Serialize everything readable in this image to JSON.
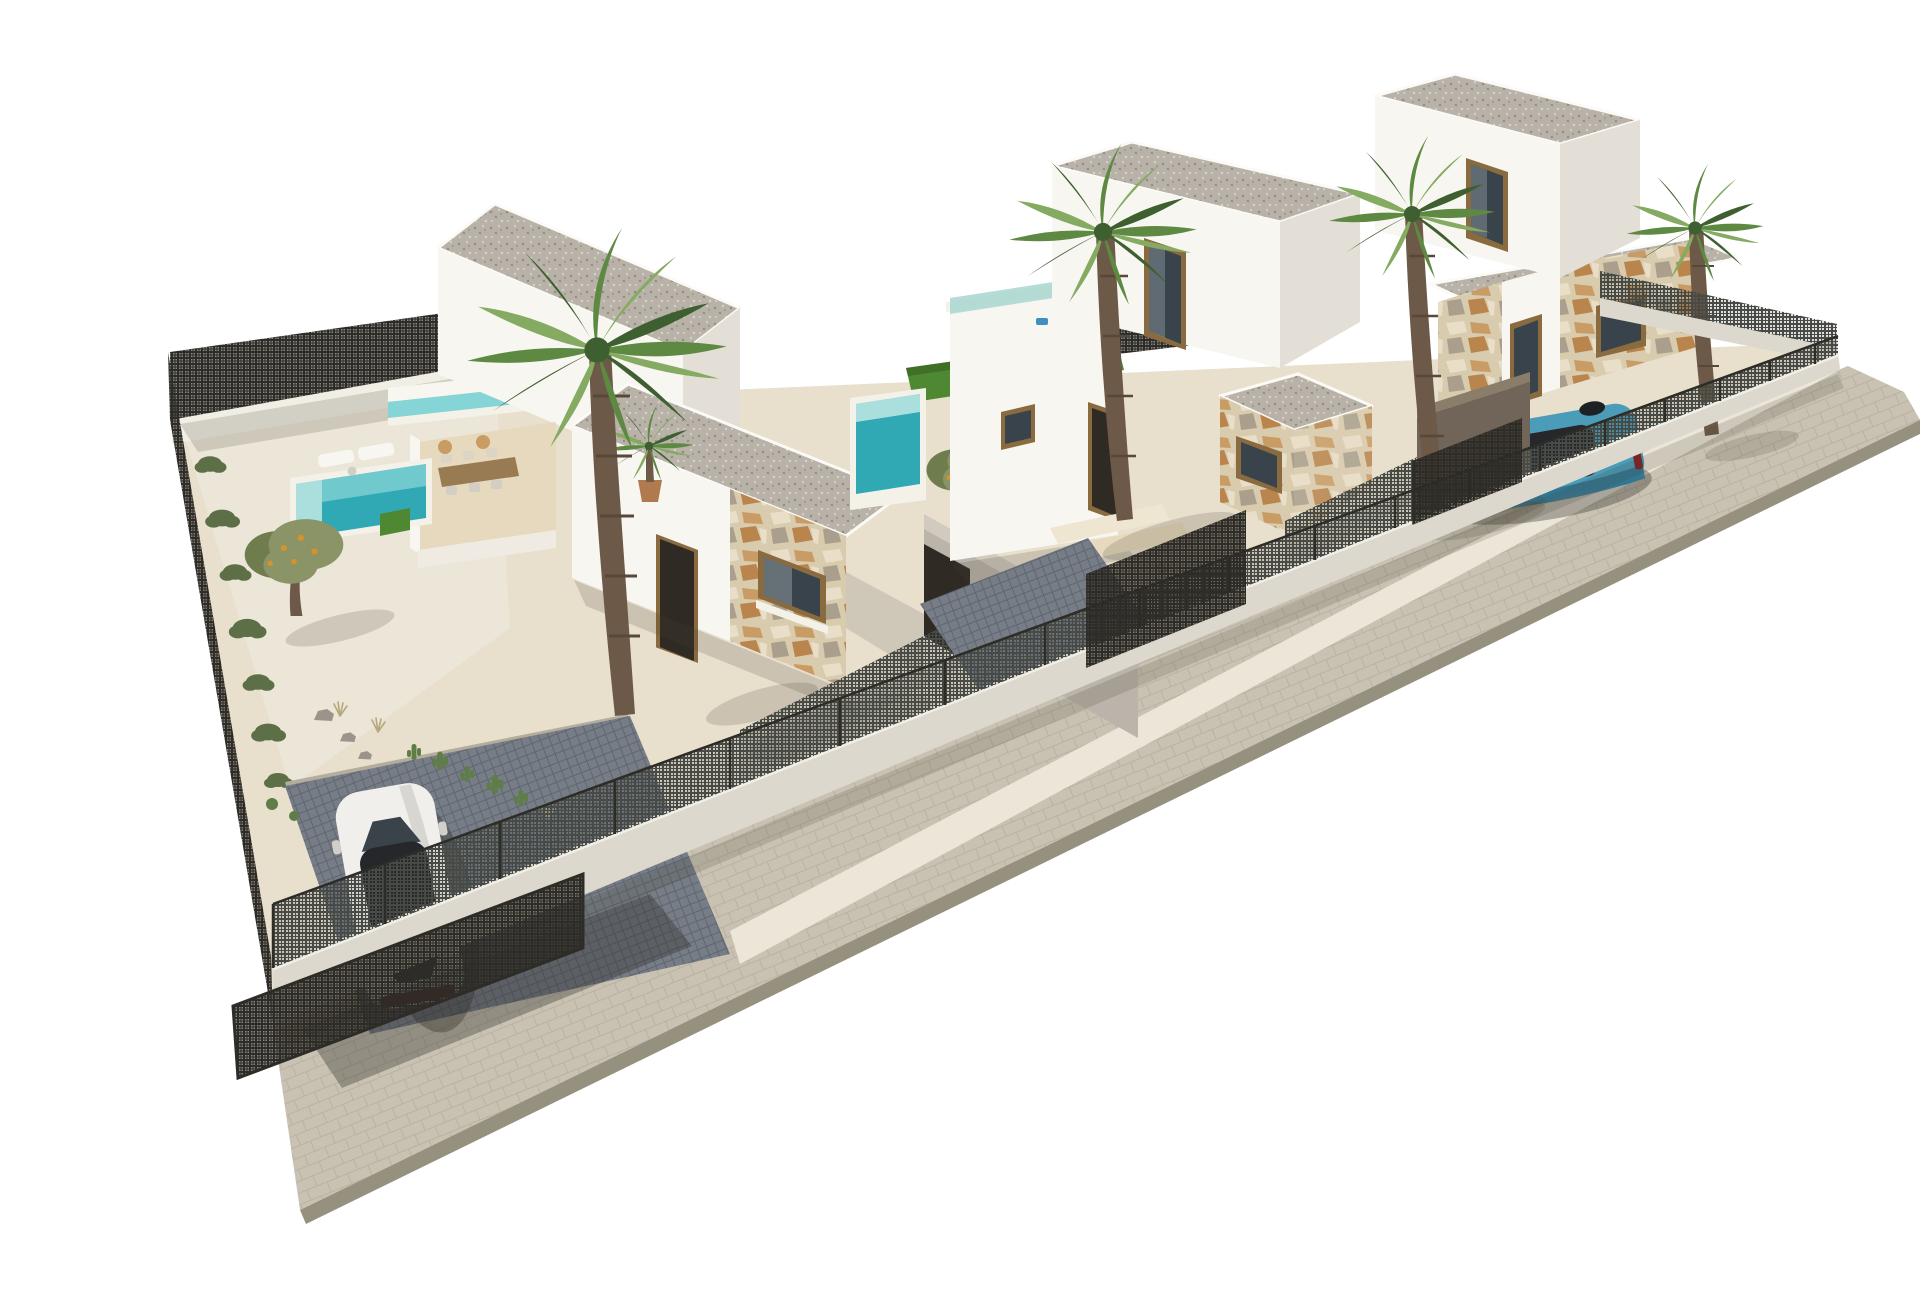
{
  "meta": {
    "title": "Aerial 3D architectural rendering of a gated development of three modern white villas with pools, palm trees and parked cars on a white background",
    "image_type": "3d-architectural-render",
    "background": "#ffffff"
  },
  "palette": {
    "bg": "#ffffff",
    "parapet": "#fbfaf6",
    "wall_lit": "#f8f6f1",
    "wall_mid": "#efebe3",
    "wall_shade": "#e3dfd6",
    "wall_dark": "#d3cec4",
    "roof_gravel": "#b8b2a8",
    "roof_dot_dark": "#948d81",
    "roof_dot_light": "#d8d3c9",
    "ground_cream": "#e8dfcd",
    "ground_gravel": "#ece6d8",
    "gravel_shade": "#ddd5c4",
    "terrace_floor": "#e6d9bd",
    "step_light": "#efe6d2",
    "driveway": "#767d87",
    "driveway_line": "#5f6670",
    "driveway_edge": "#b4ac9c",
    "sidewalk": "#c9c2b3",
    "sidewalk_line": "#b9b1a1",
    "sidewalk_edge": "#96907f",
    "pool_deep": "#31a9b4",
    "pool_light": "#85d4d6",
    "pool_step": "#aadfdd",
    "pool_coping": "#f4f1e9",
    "lawn": "#4f8833",
    "lawn_dark": "#3f7026",
    "glass_teal": "#a8d6d0",
    "glass_dark": "#39434b",
    "glass_sky": "#b9c7cc",
    "mesh_dark": "#2e2c27",
    "mesh_mid": "#474a45",
    "fence_wall": "#f1eee6",
    "fence_wall_face": "#ddd8cd",
    "stone_base": "#d9cbae",
    "stone_warm": "#c89c64",
    "stone_orange": "#b9854d",
    "stone_gray": "#a99f8c",
    "stone_light": "#e9dfc8",
    "frame_brown": "#8a6a3f",
    "frame_dark": "#6e5330",
    "door_dark": "#2f2a24",
    "trunk_brown": "#6d5947",
    "trunk_dark": "#57483a",
    "palm_dark": "#3e6030",
    "palm_mid": "#5e8943",
    "palm_light": "#85aa62",
    "olive_green": "#8a9466",
    "olive_dark": "#6e7c4e",
    "fruit_orange": "#d9912c",
    "shrub_green": "#5c6f46",
    "cactus_green": "#5f7d46",
    "rock_gray": "#9a948a",
    "grass_tan": "#b7a77c",
    "agave_green": "#7e936b",
    "car_white": "#f0efec",
    "car_white_shade": "#d2cfca",
    "car_glass": "#25272b",
    "car_red": "#7c2128",
    "car_blue": "#4b9cb8",
    "car_blue_dark": "#2f7390",
    "court_wall": "#bab4aa",
    "court_wall_lit": "#d0cabf",
    "brown_wall": "#71655a",
    "passage_floor": "#cfc8b9",
    "pot_terracotta": "#b07a4e",
    "shadow": "rgba(70,64,52,0.18)",
    "shadow_strong": "rgba(45,42,35,0.34)"
  },
  "scene": {
    "setting": "Corner plot seen from a high oblique viewpoint; the row of villas recedes diagonally from the large near plot at lower-left to the smallest far plot at upper-right; everything floats on a pure white background",
    "boundary": "Low white perimeter wall topped with dark metal mesh fence panels and posts; taller dark mesh fence along the back and left boundaries; paved sidewalk band along the street edge",
    "villas": [
      {
        "name": "villa-1",
        "position": "left, nearest and largest plot",
        "storeys": 1,
        "roof": "flat roofs ballasted with grey gravel",
        "features": [
          "tall gravel-roofed volume",
          "walled dining terrace with wooden table, chairs and two round stools",
          "potted palm on terrace",
          "elevated lap-pool channel behind terrace",
          "garden pool with two sun loungers",
          "olive tree with orange fruit",
          "hedge and shrubs along left fence",
          "stone-clad facade with picture window",
          "dark entry door",
          "grey courtyard wall with dark passage",
          "row of cacti and rocks",
          "dark paved driveway",
          "white car",
          "open mesh driveway gate"
        ]
      },
      {
        "name": "villa-2",
        "position": "middle plot",
        "storeys": 2,
        "roof": "flat roofs ballasted with grey gravel",
        "features": [
          "roof terrace with teal glass balustrade and white sun lounger",
          "upper-floor glazed door",
          "private pool with turquoise water",
          "green lawn strip",
          "small olive tree",
          "stone-clad porch volume with window",
          "recessed entrance door",
          "small side window",
          "dark paved driveway with mesh gate",
          "two palm trees"
        ]
      },
      {
        "name": "villa-3",
        "position": "right, farthest plot",
        "storeys": 2,
        "roof": "flat roofs ballasted with grey gravel",
        "features": [
          "upper-floor glazed window",
          "stone-clad facade sections",
          "dark brown carport wall",
          "parked teal-blue car",
          "mesh driveway gate",
          "tall palm tree in front",
          "corner palm tree"
        ]
      }
    ],
    "vehicles": [
      {
        "name": "white-car",
        "description": "white hatchback seen from above, parked nose-in on villa-1 dark paved driveway, dark glass roof and red tail-light strip"
      },
      {
        "name": "blue-car",
        "description": "teal-blue hatchback parked in villa-3 walled carport facing the street"
      }
    ],
    "vegetation": {
      "palm_trees": 4,
      "potted_palms": 1,
      "olive_trees": 2,
      "hedge_shrubs": 7,
      "cacti": 7,
      "ball_cacti": 2,
      "rocks": 3,
      "agaves": 2,
      "grass_tufts": 3
    },
    "pools": [
      {
        "villa": "villa-1",
        "type": "garden pool with steps",
        "color": "turquoise"
      },
      {
        "villa": "villa-1",
        "type": "elevated lap-pool channel",
        "color": "pale teal"
      },
      {
        "villa": "villa-2",
        "type": "garden pool with lawn surround",
        "color": "turquoise"
      }
    ]
  }
}
